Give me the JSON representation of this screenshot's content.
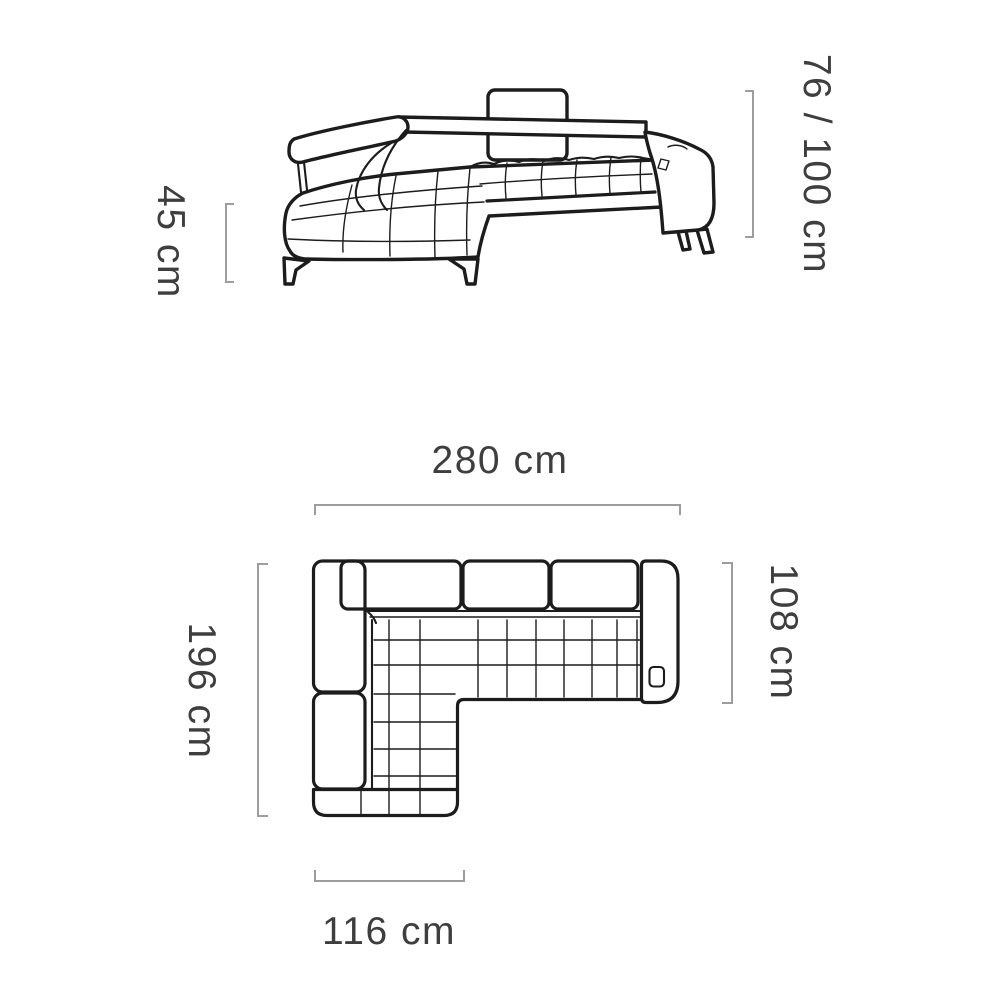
{
  "colors": {
    "background": "#ffffff",
    "sofa_outline": "#1c1c1c",
    "dimension_lines": "#9d9d9d",
    "label_text": "#3e3e3e"
  },
  "side_view": {
    "height_label": "76 / 100 cm",
    "seat_height_label": "45 cm"
  },
  "top_view": {
    "width_label": "280 cm",
    "depth_label": "196 cm",
    "right_depth_label": "108 cm",
    "chaise_width_label": "116 cm"
  }
}
